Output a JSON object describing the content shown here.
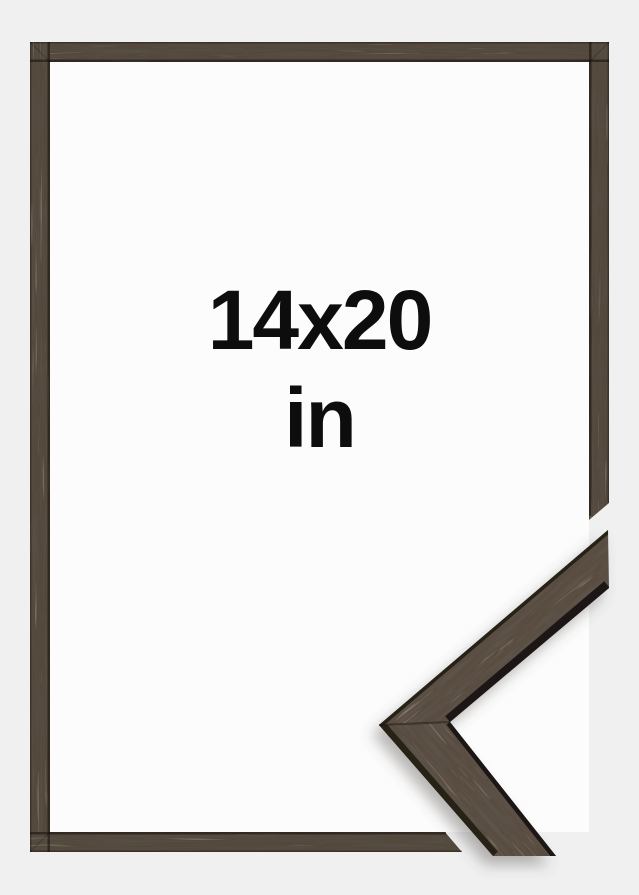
{
  "product_preview": {
    "size_label": "14x20",
    "unit_label": "in"
  },
  "colors": {
    "background": "#f0f0f1",
    "paper": "#fcfcfc",
    "wood": "#51463a",
    "wood_face": "#57493c",
    "wood_edge": "#262019",
    "wood_edge_dark": "#1b1612",
    "text": "#0d0d0d"
  },
  "icons": {
    "frame_corner_sample": "walnut-moulding-corner",
    "frame_border": "walnut-thin-frame"
  }
}
